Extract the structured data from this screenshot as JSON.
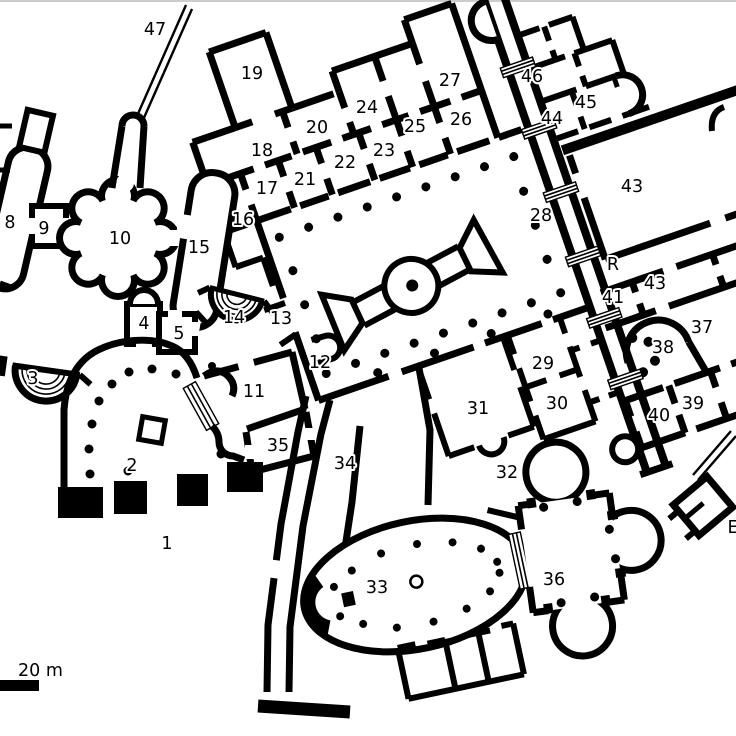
{
  "plan": {
    "description_visible_text_only": true,
    "colors": {
      "background": "#ffffff",
      "walls": "#000000",
      "label_text": "#000000"
    }
  },
  "scale_bar": {
    "label": "20 m"
  },
  "labels": [
    {
      "text": "47",
      "x": 155,
      "y": 29
    },
    {
      "text": "19",
      "x": 252,
      "y": 73
    },
    {
      "text": "27",
      "x": 450,
      "y": 80
    },
    {
      "text": "46",
      "x": 532,
      "y": 76
    },
    {
      "text": "45",
      "x": 586,
      "y": 102
    },
    {
      "text": "44",
      "x": 552,
      "y": 118
    },
    {
      "text": "26",
      "x": 461,
      "y": 119
    },
    {
      "text": "25",
      "x": 415,
      "y": 126
    },
    {
      "text": "24",
      "x": 367,
      "y": 107
    },
    {
      "text": "20",
      "x": 317,
      "y": 127
    },
    {
      "text": "23",
      "x": 384,
      "y": 150
    },
    {
      "text": "18",
      "x": 262,
      "y": 150
    },
    {
      "text": "22",
      "x": 345,
      "y": 162
    },
    {
      "text": "21",
      "x": 305,
      "y": 179
    },
    {
      "text": "17",
      "x": 267,
      "y": 188
    },
    {
      "text": "16",
      "x": 243,
      "y": 219
    },
    {
      "text": "43",
      "x": 632,
      "y": 186
    },
    {
      "text": "28",
      "x": 541,
      "y": 215
    },
    {
      "text": "R",
      "x": 613,
      "y": 264
    },
    {
      "text": "43",
      "x": 655,
      "y": 283
    },
    {
      "text": "41",
      "x": 613,
      "y": 297
    },
    {
      "text": "8",
      "x": 10,
      "y": 222
    },
    {
      "text": "9",
      "x": 44,
      "y": 228
    },
    {
      "text": "10",
      "x": 120,
      "y": 238
    },
    {
      "text": "15",
      "x": 199,
      "y": 247
    },
    {
      "text": "14",
      "x": 234,
      "y": 317
    },
    {
      "text": "13",
      "x": 281,
      "y": 318
    },
    {
      "text": "12",
      "x": 320,
      "y": 362
    },
    {
      "text": "4",
      "x": 144,
      "y": 323
    },
    {
      "text": "5",
      "x": 179,
      "y": 333
    },
    {
      "text": "3",
      "x": 33,
      "y": 378
    },
    {
      "text": "2",
      "x": 132,
      "y": 465
    },
    {
      "text": "11",
      "x": 254,
      "y": 391
    },
    {
      "text": "35",
      "x": 278,
      "y": 445
    },
    {
      "text": "34",
      "x": 345,
      "y": 463
    },
    {
      "text": "1",
      "x": 167,
      "y": 543
    },
    {
      "text": "37",
      "x": 702,
      "y": 327
    },
    {
      "text": "38",
      "x": 663,
      "y": 347
    },
    {
      "text": "39",
      "x": 693,
      "y": 403
    },
    {
      "text": "40",
      "x": 659,
      "y": 415
    },
    {
      "text": "29",
      "x": 543,
      "y": 363
    },
    {
      "text": "30",
      "x": 557,
      "y": 403
    },
    {
      "text": "31",
      "x": 478,
      "y": 408
    },
    {
      "text": "32",
      "x": 507,
      "y": 472
    },
    {
      "text": "33",
      "x": 377,
      "y": 587
    },
    {
      "text": "36",
      "x": 554,
      "y": 579
    },
    {
      "text": "E",
      "x": 733,
      "y": 527
    }
  ]
}
